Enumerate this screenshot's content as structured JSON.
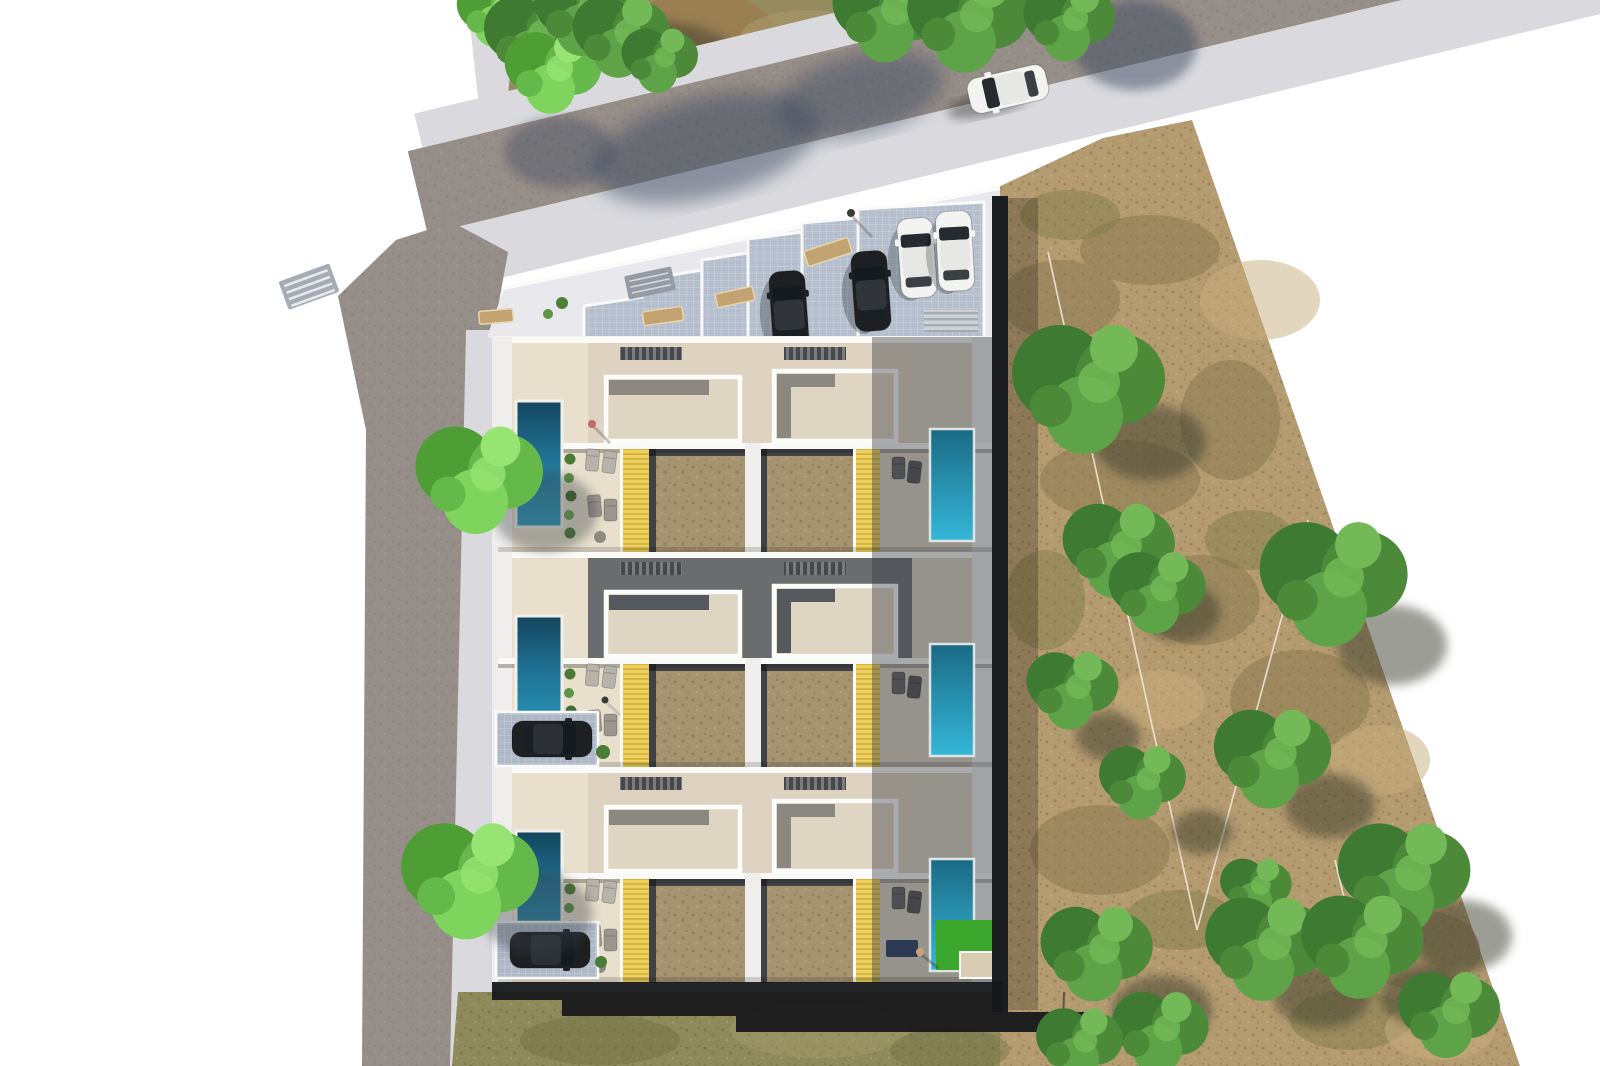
{
  "scene": {
    "type": "aerial-architectural-site-plan-render",
    "description": "Top-down photorealistic architectural rendering of a residential development: six attached villas in three rows with private pools, yellow pergola decks, sand-colored courtyards, a tiled parking court with four parked cars, perimeter roads with sidewalks, a white car driving on the top road, two cars in side driveways, bright green lawns, and a large dry tan field with scattered trees on the right",
    "villa_rows": 3,
    "villas_per_row": 2,
    "villa_count": 6,
    "pool_count": 6,
    "parking_court_cars": 4,
    "driveway_cars": 2,
    "road_cars": 1,
    "tree_count_approx": 26,
    "people_count": 4
  },
  "palette": {
    "bg": "#ffffff",
    "road": "#968e88",
    "roadShadow": "#3d4960",
    "sidewalk": "#dadade",
    "apron": "#e9e8ec",
    "parkingTile": "#b4becc",
    "driveTile": "#aeb8c6",
    "wall": "#f4f3f1",
    "wall2": "#efeeec",
    "band": "#fafaf9",
    "roofLight": "#ddd3c0",
    "roofDark": "#6a6c6d",
    "slab": "#ded5c2",
    "slabNotch": "#8a8881",
    "terrace": "#e8e0cd",
    "terraceShadow": "#d9d2c2",
    "yellow": "#edd05f",
    "yellowSlat": "#d3b23b",
    "brown": "#a6936f",
    "brownFrame": "#202125",
    "poolDeepL": "#14455c",
    "poolLightL": "#2c9dc0",
    "poolDeepR": "#1b6a85",
    "poolLightR": "#35b7d8",
    "lawn": "#3aa62c",
    "planter": "#4a7b36",
    "field": "#b59b70",
    "fieldDark": "#8b7a52",
    "grassBand": "#8f8a5c",
    "topGrass": "#968a5f",
    "dirt": "#9b7b4f",
    "treeDark": "#3f7a33",
    "treeMid": "#4c8a3a",
    "treeLight": "#5fa348",
    "treeTip": "#73b957",
    "brightDark": "#4f9e35",
    "brightMid": "#65b94a",
    "brightLight": "#7fd45e",
    "brightTip": "#97e473",
    "carBlack": "#1d1f22",
    "carWhite": "#f3f3f2",
    "tanBench": "#c2a371",
    "panelGray": "#959ba5",
    "crosswalk": "#a7acb4",
    "shadow": "#16171a",
    "navy": "#2b3a52",
    "fence": "#ece5d4"
  }
}
